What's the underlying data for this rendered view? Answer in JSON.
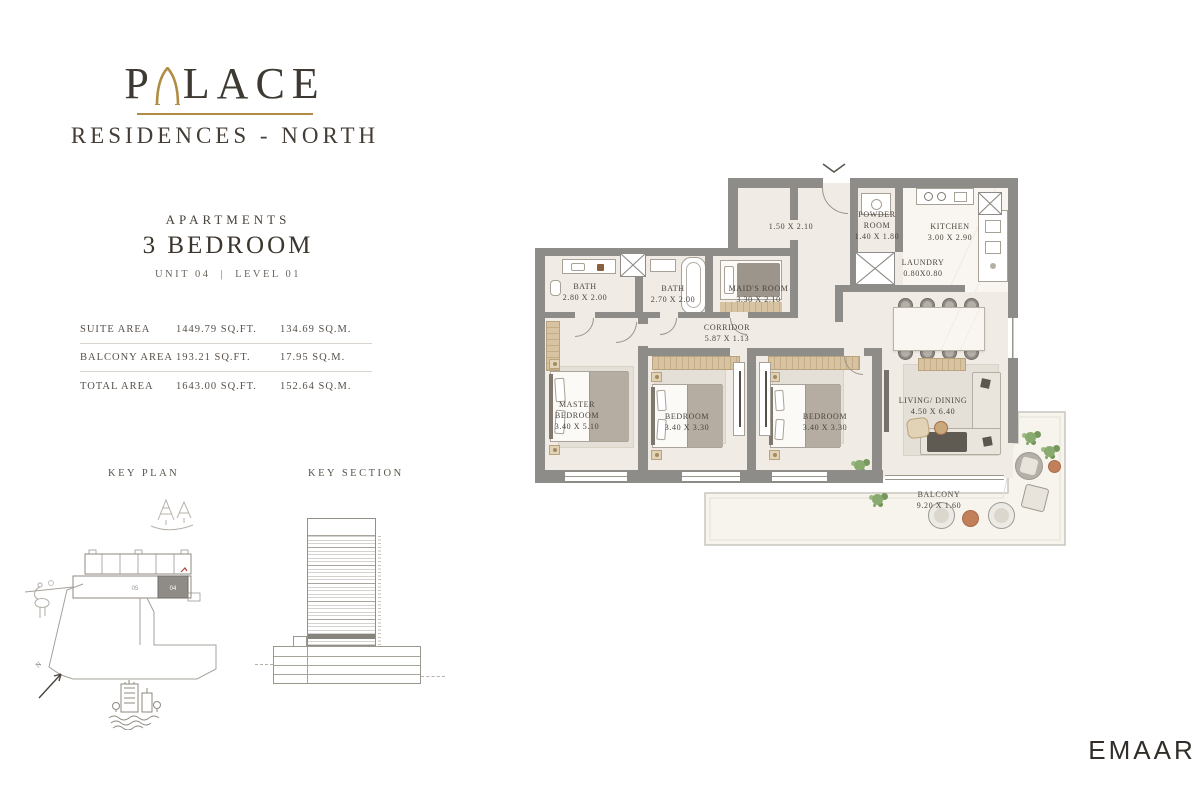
{
  "brand": {
    "name_prefix": "P",
    "name_suffix": "LACE",
    "subtitle": "RESIDENCES - NORTH"
  },
  "header": {
    "category": "APARTMENTS",
    "title": "3 BEDROOM",
    "unit": "UNIT 04",
    "divider": "|",
    "level": "LEVEL 01"
  },
  "area_table": {
    "rows": [
      {
        "label": "SUITE AREA",
        "sqft": "1449.79 SQ.FT.",
        "sqm": "134.69 SQ.M."
      },
      {
        "label": "BALCONY AREA",
        "sqft": "193.21 SQ.FT.",
        "sqm": "17.95 SQ.M."
      },
      {
        "label": "TOTAL AREA",
        "sqft": "1643.00 SQ.FT.",
        "sqm": "152.64 SQ.M."
      }
    ]
  },
  "key_plan": {
    "title": "KEY PLAN",
    "highlighted_unit": "04",
    "adjacent_unit": "05",
    "north": "N"
  },
  "key_section": {
    "title": "KEY SECTION"
  },
  "floor_plan": {
    "rooms": [
      {
        "name": "BATH",
        "dims": "2.80 X 2.00"
      },
      {
        "name": "BATH",
        "dims": "2.70 X 2.00"
      },
      {
        "name": "MAID'S ROOM",
        "dims": "3.30 X 2.10"
      },
      {
        "name": "",
        "dims": "1.50 X 2.10"
      },
      {
        "name": "POWDER ROOM",
        "dims": "1.40 X 1.80"
      },
      {
        "name": "KITCHEN",
        "dims": "3.00 X 2.90"
      },
      {
        "name": "LAUNDRY",
        "dims": "0.80X0.80"
      },
      {
        "name": "CORRIDOR",
        "dims": "5.87 X 1.13"
      },
      {
        "name": "MASTER BEDROOM",
        "dims": "3.40 X 5.10"
      },
      {
        "name": "BEDROOM",
        "dims": "3.40 X 3.30"
      },
      {
        "name": "BEDROOM",
        "dims": "3.40 X 3.30"
      },
      {
        "name": "LIVING/ DINING",
        "dims": "4.50 X 6.40"
      },
      {
        "name": "BALCONY",
        "dims": "9.20 X 1.60"
      }
    ]
  },
  "footer": {
    "logo": "EMAAR"
  },
  "colors": {
    "gold": "#b08d44",
    "wall": "#8d8c88",
    "floor": "#f0ece5",
    "text": "#3f3a34"
  }
}
